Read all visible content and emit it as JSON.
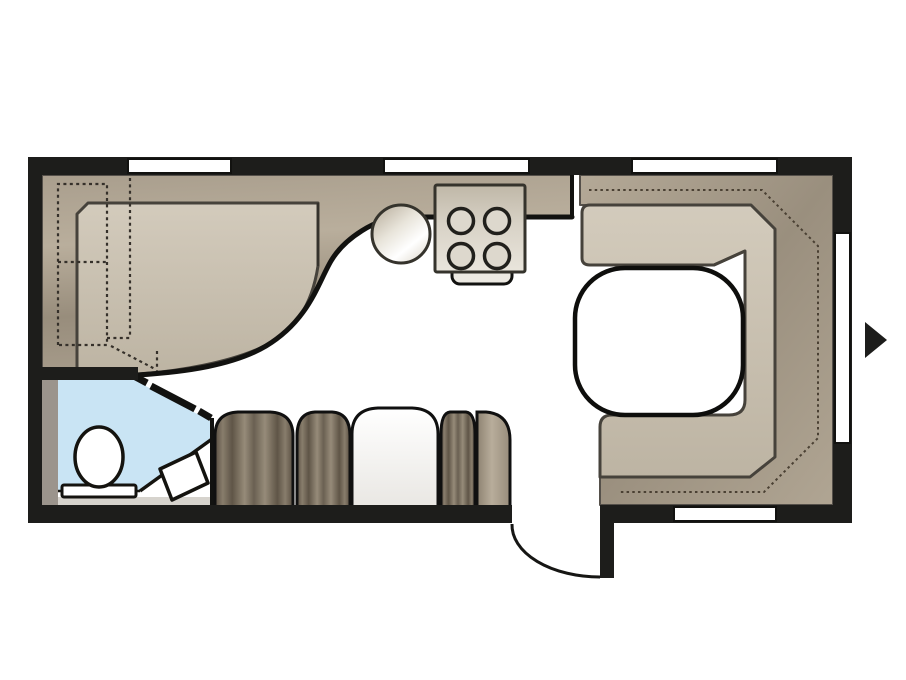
{
  "floorplan": {
    "title": "caravan-floor-plan-top-view",
    "description": "Top-down interior layout of a caravan: front corner bed, mid kitchen with round sink and 4-burner hob, bathroom with toilet and corner basin, side bench of cushion segments, rear U-shaped lounge with table, entry door with swing arc and right-side entrance arrow",
    "rooms": [
      {
        "name": "front-bedroom",
        "features": [
          "corner-bed",
          "wardrobe-dashed-outline"
        ]
      },
      {
        "name": "kitchen",
        "features": [
          "round-sink",
          "four-burner-hob",
          "oven-handle",
          "worktop"
        ]
      },
      {
        "name": "bathroom",
        "features": [
          "toilet",
          "corner-washbasin",
          "diagonal-sliding-door",
          "shower-trim"
        ]
      },
      {
        "name": "living-area",
        "features": [
          "side-bench-cushions",
          "u-shaped-lounge",
          "lounge-table",
          "backrest-stitch-line"
        ]
      }
    ],
    "counts": {
      "hob_burners": 4,
      "bench_segments": 5,
      "top_windows": 3,
      "right_windows": 1,
      "bottom_windows": 1
    },
    "doors": {
      "entry_door": "bottom wall between bench and lounge, quarter-circle swing arc",
      "bathroom_door": "thick diagonal bar with hinge gaps",
      "entrance_marker": "black triangle arrow pointing right at exterior right wall"
    },
    "colors": {
      "wall": "#1d1d1b",
      "floor": "#ffffff",
      "outline": "#46423b",
      "line_black": "#14130f",
      "bathroom_blue": "#c9e4f4",
      "gray_trim": "#9b948c",
      "step_trim": "#d6d3cd",
      "dark_tan": "#a89d8c",
      "light_tan": "#cac1b0",
      "cushion_brown": "#7c7162",
      "stove_fill": "#d8d2c6",
      "fixture_white": "#ffffff"
    }
  }
}
